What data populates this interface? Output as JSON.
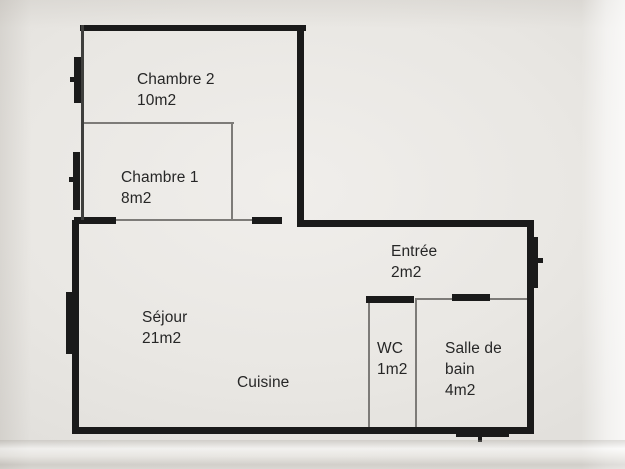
{
  "document": {
    "kind": "apartment-floor-plan-photo",
    "language": "fr"
  },
  "palette": {
    "wall": "#1a1a1a",
    "partition": "#7d7b78",
    "frame": "#3f3f3d",
    "paper": "#e9e7e3",
    "ink": "#262626"
  },
  "rooms": [
    {
      "id": "chambre-2",
      "name": "Chambre 2",
      "area": "10m2"
    },
    {
      "id": "chambre-1",
      "name": "Chambre 1",
      "area": "8m2"
    },
    {
      "id": "sejour",
      "name": "Séjour",
      "area": "21m2"
    },
    {
      "id": "cuisine",
      "name": "Cuisine",
      "area": ""
    },
    {
      "id": "entree",
      "name": "Entrée",
      "area": "2m2"
    },
    {
      "id": "wc",
      "name": "WC",
      "area": "1m2"
    },
    {
      "id": "salle-de-bain",
      "name": "Salle de bain",
      "area": "4m2"
    }
  ]
}
